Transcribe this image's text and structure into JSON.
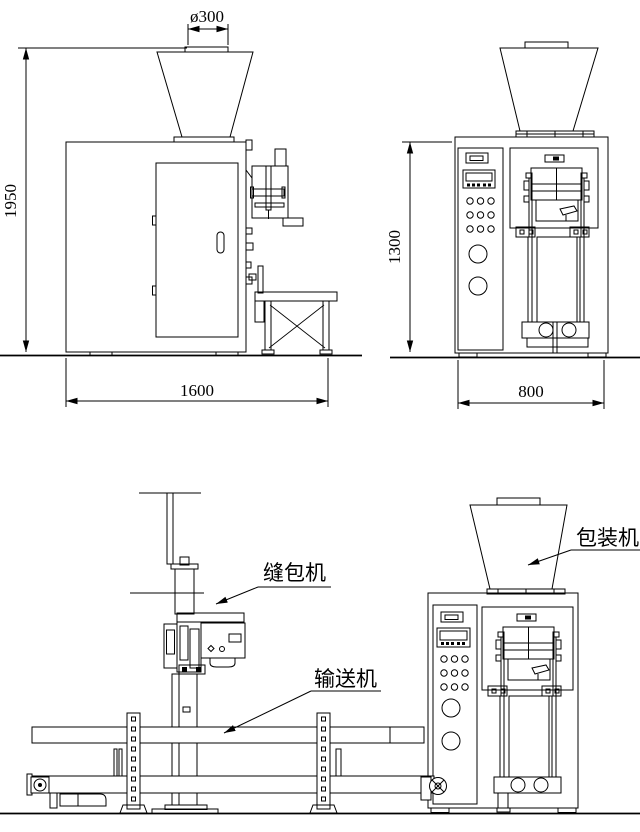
{
  "drawing": {
    "background": "#ffffff",
    "line_color": "#000000",
    "side_view": {
      "dim_diameter": "ø300",
      "dim_height": "1950",
      "dim_width": "1600"
    },
    "front_view": {
      "dim_height": "1300",
      "dim_width": "800"
    },
    "assembly_view": {
      "label_sewing_machine": "缝包机",
      "label_conveyor": "输送机",
      "label_packing_machine": "包装机"
    }
  }
}
